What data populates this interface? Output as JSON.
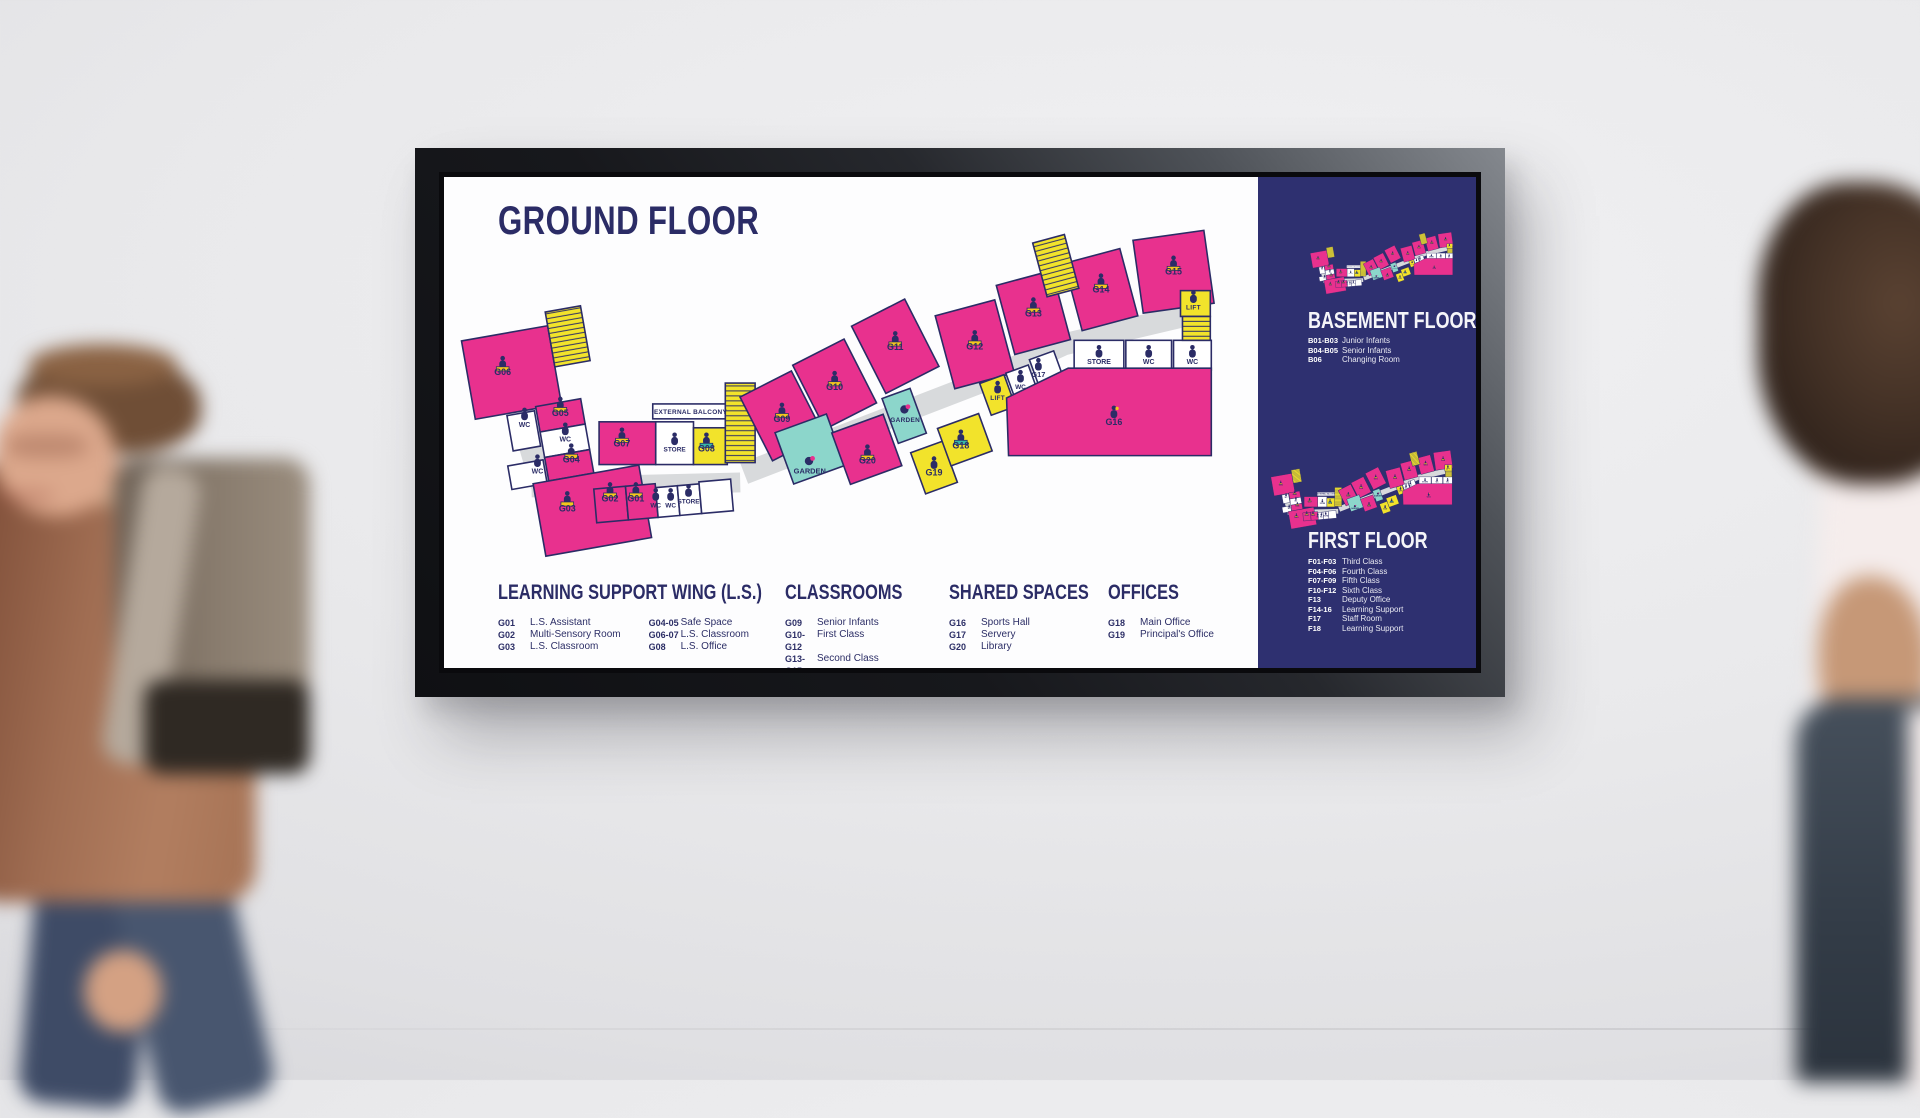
{
  "sign": {
    "title": "GROUND FLOOR",
    "colors": {
      "pink": "#e8318e",
      "yellow": "#f2e32b",
      "teal": "#8cd6cb",
      "navy": "#2b2c66",
      "panel_navy": "#2e3070",
      "corridor_grey": "#d8dadc"
    },
    "legend_sections": [
      {
        "title": "LEARNING SUPPORT WING (L.S.)",
        "columns": [
          {
            "entries": [
              {
                "code": "G01",
                "name": "L.S. Assistant"
              },
              {
                "code": "G02",
                "name": "Multi-Sensory Room"
              },
              {
                "code": "G03",
                "name": "L.S. Classroom"
              }
            ]
          },
          {
            "entries": [
              {
                "code": "G04-05",
                "name": "Safe Space"
              },
              {
                "code": "G06-07",
                "name": "L.S. Classroom"
              },
              {
                "code": "G08",
                "name": "L.S. Office"
              }
            ]
          }
        ]
      },
      {
        "title": "CLASSROOMS",
        "columns": [
          {
            "entries": [
              {
                "code": "G09",
                "name": "Senior Infants"
              },
              {
                "code": "G10-G12",
                "name": "First Class"
              },
              {
                "code": "G13-G15",
                "name": "Second Class"
              }
            ]
          }
        ]
      },
      {
        "title": "SHARED SPACES",
        "columns": [
          {
            "entries": [
              {
                "code": "G16",
                "name": "Sports Hall"
              },
              {
                "code": "G17",
                "name": "Servery"
              },
              {
                "code": "G20",
                "name": "Library"
              }
            ]
          }
        ]
      },
      {
        "title": "OFFICES",
        "columns": [
          {
            "entries": [
              {
                "code": "G18",
                "name": "Main Office"
              },
              {
                "code": "G19",
                "name": "Principal's Office"
              }
            ]
          }
        ]
      }
    ],
    "side_panel": {
      "floors": [
        {
          "title": "BASEMENT FLOOR",
          "entries": [
            {
              "code": "B01-B03",
              "name": "Junior Infants"
            },
            {
              "code": "B04-B05",
              "name": "Senior Infants"
            },
            {
              "code": "B06",
              "name": "Changing Room"
            }
          ]
        },
        {
          "title": "FIRST FLOOR",
          "entries": [
            {
              "code": "F01-F03",
              "name": "Third Class"
            },
            {
              "code": "F04-F06",
              "name": "Fourth Class"
            },
            {
              "code": "F07-F09",
              "name": "Fifth Class"
            },
            {
              "code": "F10-F12",
              "name": "Sixth Class"
            },
            {
              "code": "F13",
              "name": "Deputy Office"
            },
            {
              "code": "F14-16",
              "name": "Learning Support"
            },
            {
              "code": "F17",
              "name": "Staff Room"
            },
            {
              "code": "F18",
              "name": "Learning Support"
            }
          ]
        }
      ]
    },
    "floor_plan": {
      "labels": {
        "g01": "G01",
        "g02": "G02",
        "g03": "G03",
        "g04": "G04",
        "g05": "G05",
        "g06": "G06",
        "g07": "G07",
        "g08": "G08",
        "g09": "G09",
        "g10": "G10",
        "g11": "G11",
        "g12": "G12",
        "g13": "G13",
        "g14": "G14",
        "g15": "G15",
        "g16": "G16",
        "g17": "G17",
        "g18": "G18",
        "g19": "G19",
        "g20": "G20",
        "wc": "WC",
        "store": "STORE",
        "lift": "LIFT",
        "garden": "GARDEN",
        "external_balcony": "EXTERNAL BALCONY"
      }
    }
  }
}
